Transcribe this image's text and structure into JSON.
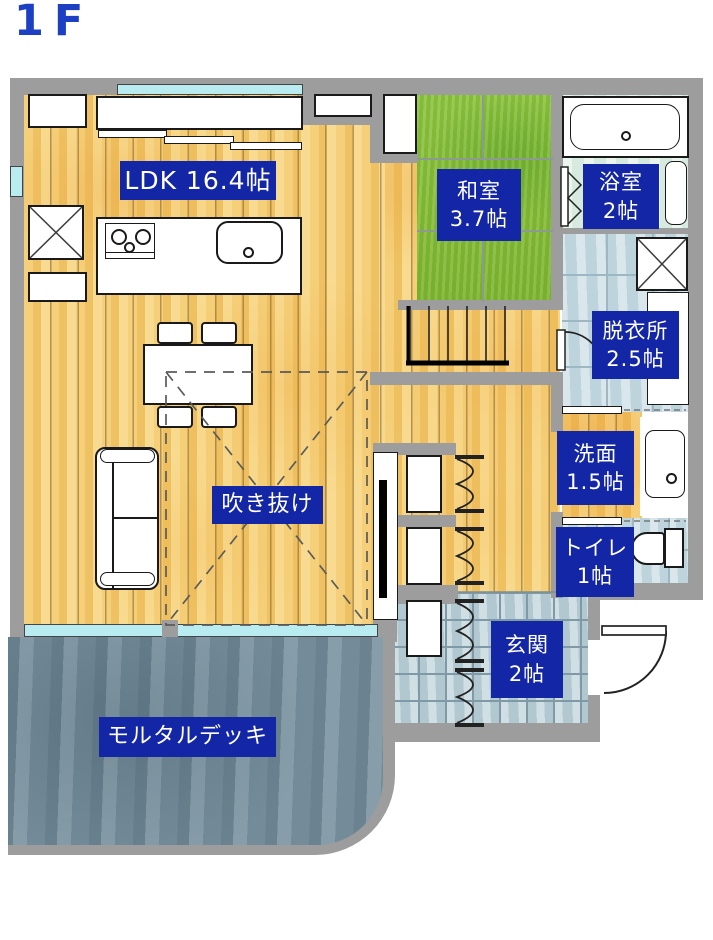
{
  "title": "1F",
  "colors": {
    "label_bg": "#1326a6",
    "label_text": "#ffffff",
    "title_blue": "#1d3fc2",
    "wall_gray": "#9d9d9d",
    "wood_floor": "#f0c66c",
    "tatami_green": "#86c03a",
    "tile_blue": "#ccdfe6",
    "deck_slate": "#7e96a3",
    "window_cyan": "#b9ecf1"
  },
  "rooms": {
    "ldk": {
      "label": "LDK 16.4帖"
    },
    "washitsu": {
      "name": "和室",
      "size": "3.7帖"
    },
    "bathroom": {
      "name": "浴室",
      "size": "2帖"
    },
    "datsuijo": {
      "name": "脱衣所",
      "size": "2.5帖"
    },
    "senmen": {
      "name": "洗面",
      "size": "1.5帖"
    },
    "toilet": {
      "name": "トイレ",
      "size": "1帖"
    },
    "genkan": {
      "name": "玄関",
      "size": "2帖"
    },
    "fukinuke": {
      "label": "吹き抜け"
    },
    "deck": {
      "label": "モルタルデッキ"
    }
  },
  "fixtures": [
    "bathtub",
    "kitchen-counter",
    "kitchen-island",
    "stove",
    "kitchen-sink",
    "refrigerator-space",
    "dining-table",
    "chairs",
    "sofa",
    "stairs",
    "washing-machine-space",
    "vanity-sink",
    "toilet-fixture",
    "closets",
    "bifold-doors",
    "entry-door",
    "windows",
    "atrium-dashed-outline"
  ]
}
